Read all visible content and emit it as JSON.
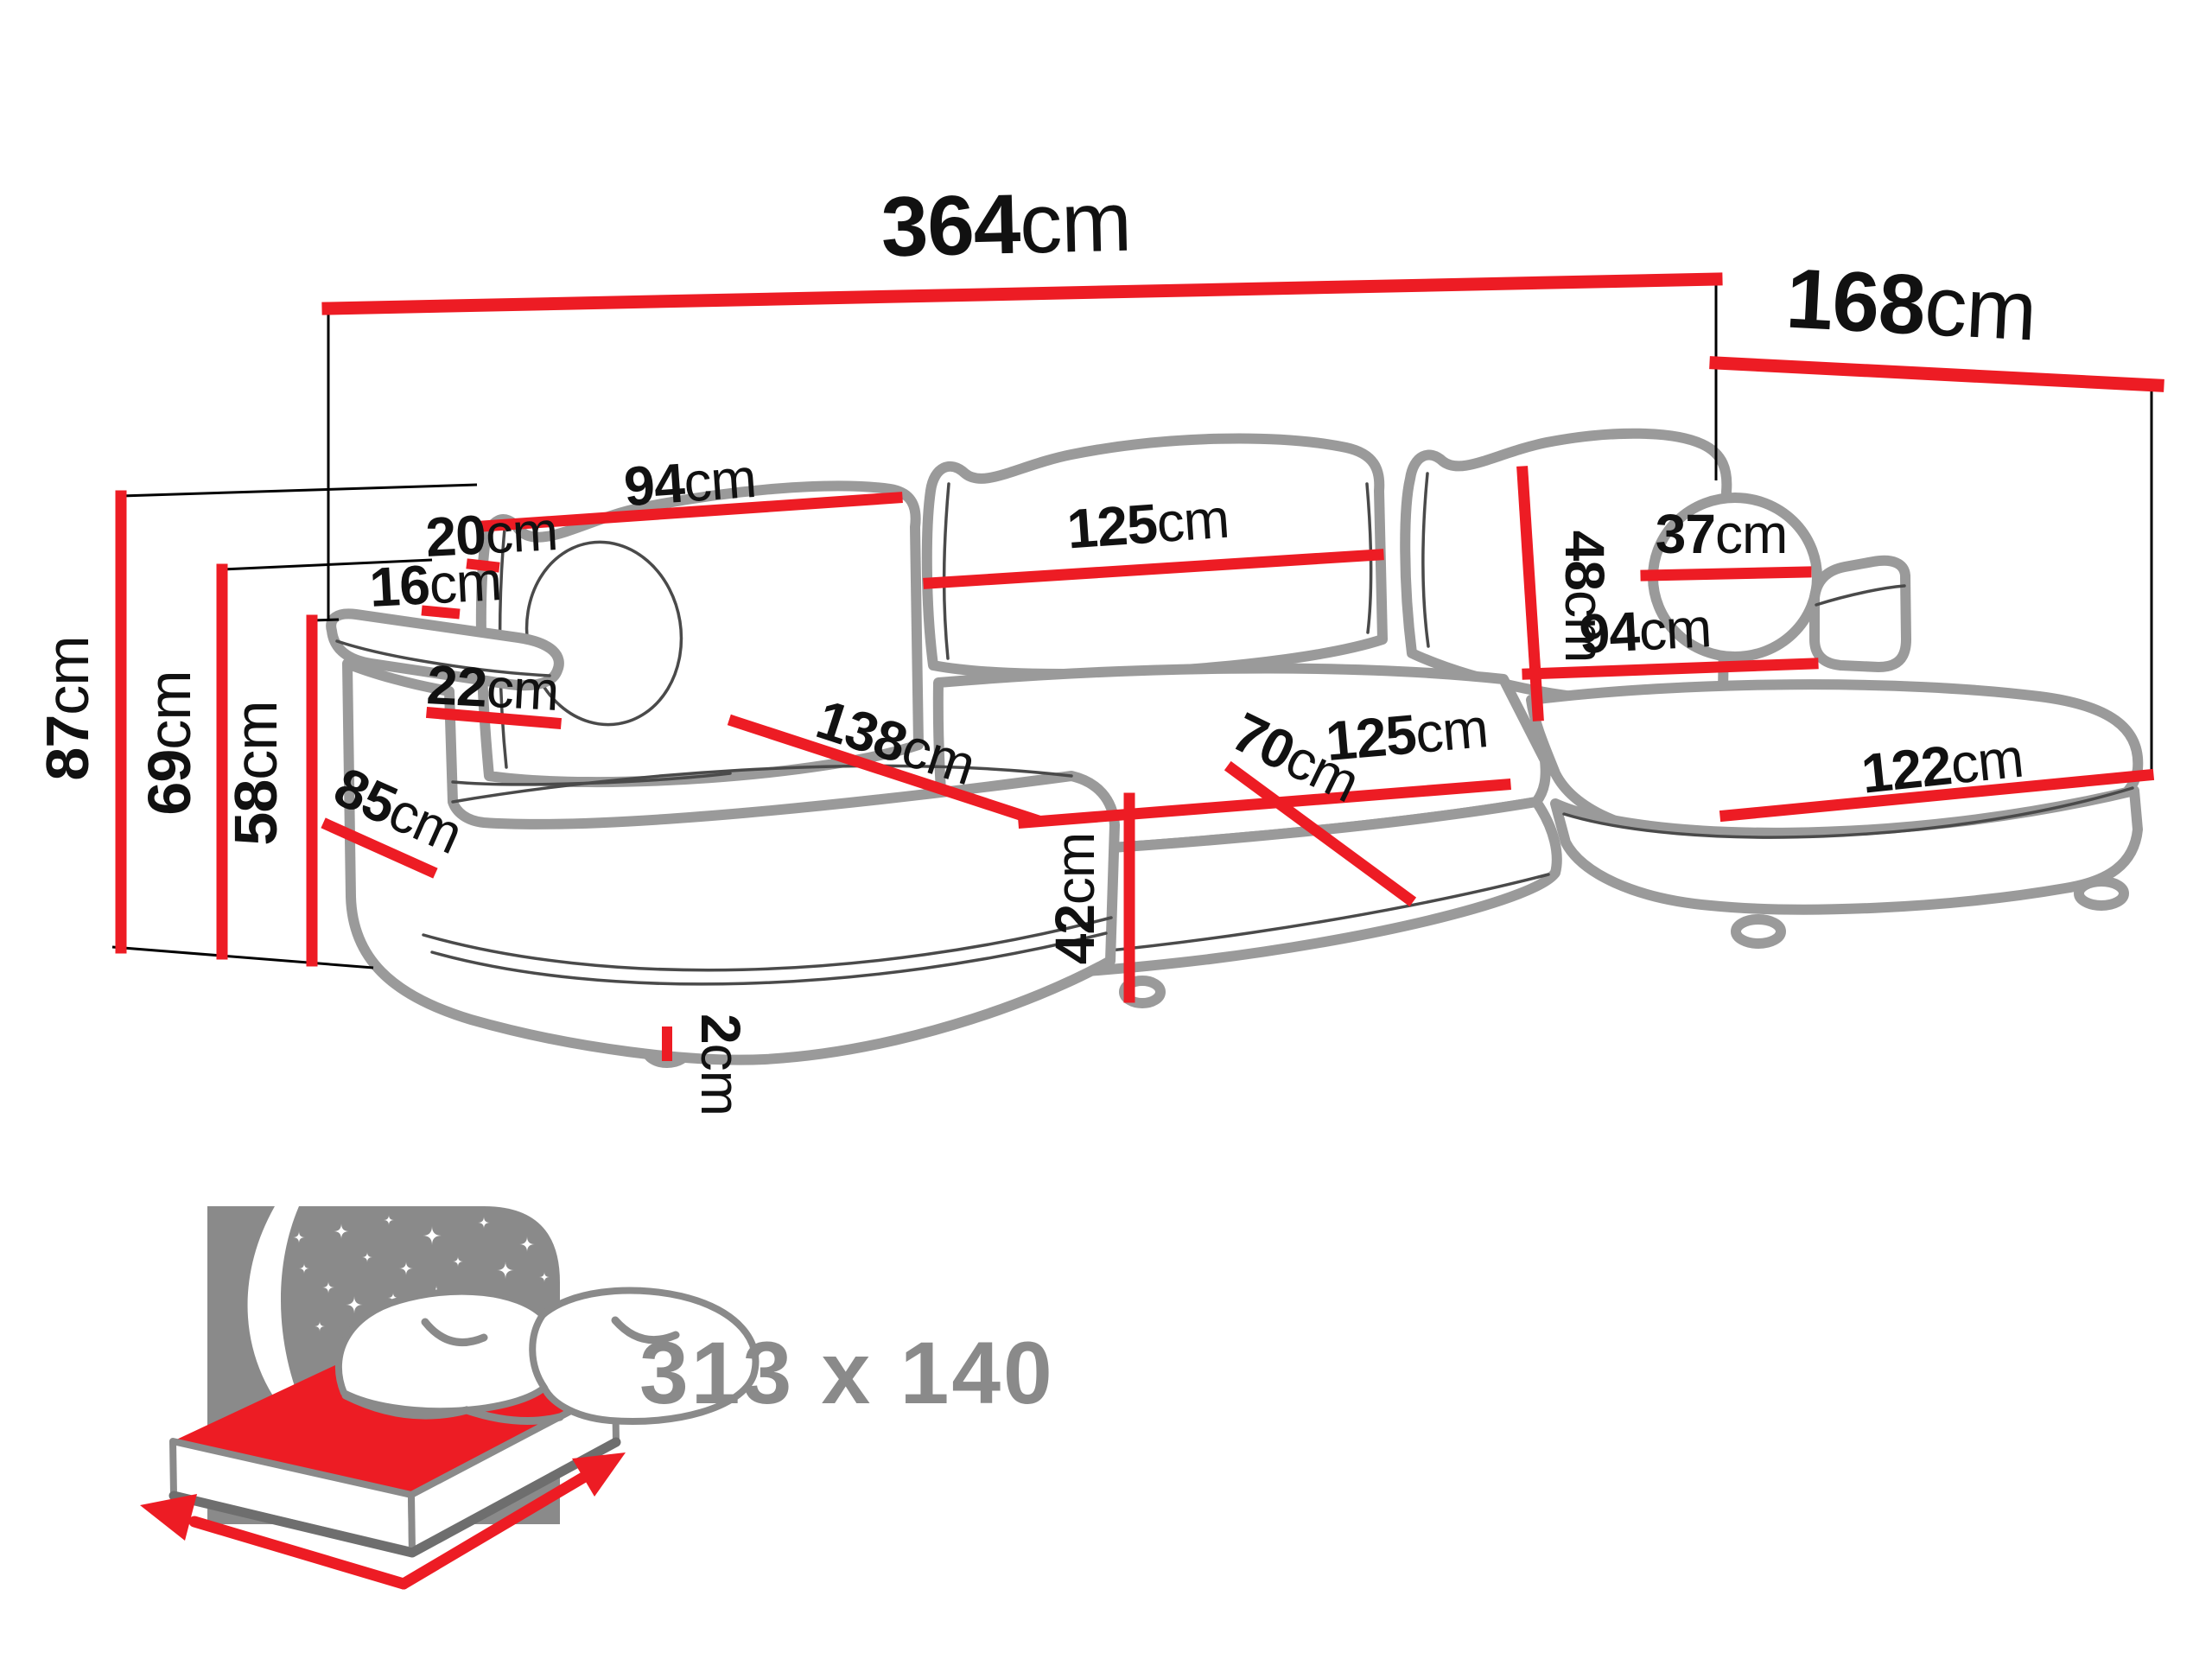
{
  "diagram_type": "sofa-dimension-diagram",
  "unit_default": "cm",
  "labels": [
    {
      "value": "364",
      "unit": "cm"
    },
    {
      "value": "168",
      "unit": "cm"
    },
    {
      "value": "87",
      "unit": "cm"
    },
    {
      "value": "69",
      "unit": "cm"
    },
    {
      "value": "58",
      "unit": "cm"
    },
    {
      "value": "20",
      "unit": "cm"
    },
    {
      "value": "16",
      "unit": "cm"
    },
    {
      "value": "22",
      "unit": "cm"
    },
    {
      "value": "85",
      "unit": "cm"
    },
    {
      "value": "94",
      "unit": "cm"
    },
    {
      "value": "125",
      "unit": "cm"
    },
    {
      "value": "48",
      "unit": "cm"
    },
    {
      "value": "37",
      "unit": "cm"
    },
    {
      "value": "94",
      "unit": "cm"
    },
    {
      "value": "70",
      "unit": "cm"
    },
    {
      "value": "125",
      "unit": "cm"
    },
    {
      "value": "138",
      "unit": "cm"
    },
    {
      "value": "42",
      "unit": "cm"
    },
    {
      "value": "2",
      "unit": "cm"
    },
    {
      "value": "122",
      "unit": "cm"
    }
  ],
  "sleeping_area": {
    "value": "313 x 140"
  },
  "colors": {
    "dimension_red": "#ed1c24",
    "outline_gray": "#9a9a9a",
    "detail_gray": "#4a4a4a",
    "icon_gray": "#8a8a8a",
    "text_black": "#111111",
    "background": "#ffffff"
  }
}
